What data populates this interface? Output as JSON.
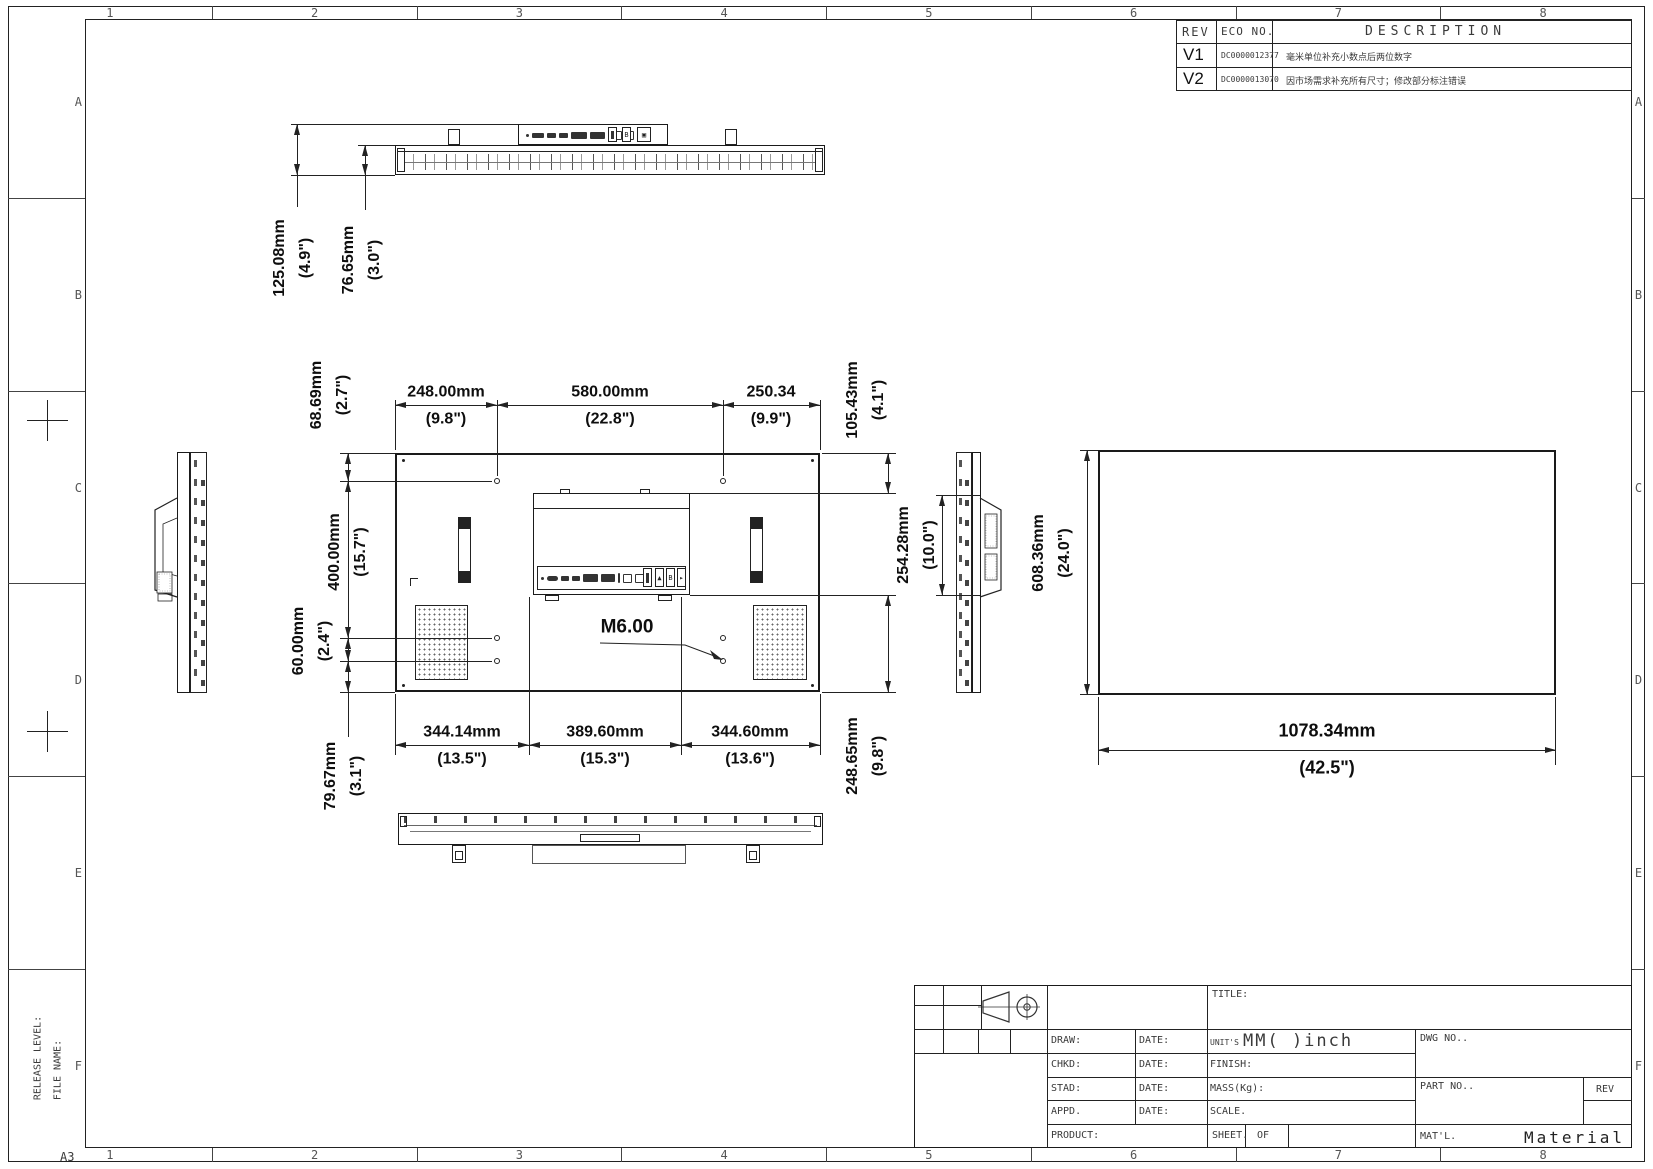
{
  "sheet": {
    "size_label": "A3",
    "grid_columns": [
      "1",
      "2",
      "3",
      "4",
      "5",
      "6",
      "7",
      "8"
    ],
    "grid_rows": [
      "A",
      "B",
      "C",
      "D",
      "E",
      "F"
    ],
    "release_level_label": "RELEASE LEVEL:",
    "file_name_label": "FILE NAME:"
  },
  "revision_table": {
    "headers": [
      "REV",
      "ECO NO.",
      "DESCRIPTION"
    ],
    "rows": [
      {
        "rev": "V1",
        "eco_no": "DC0000012377",
        "description": "毫米单位补充小数点后两位数字"
      },
      {
        "rev": "V2",
        "eco_no": "DC0000013070",
        "description": "因市场需求补充所有尺寸；修改部分标注错误"
      }
    ]
  },
  "title_block": {
    "title_label": "TITLE:",
    "draw_label": "DRAW:",
    "chkd_label": "CHKD:",
    "stad_label": "STAD:",
    "appd_label": "APPD.",
    "date_label": "DATE:",
    "product_label": "PRODUCT:",
    "units_label": "UNIT'S",
    "units_value": "MM( )inch",
    "finish_label": "FINISH:",
    "mass_label": "MASS(Kg):",
    "scale_label": "SCALE.",
    "dwg_no_label": "DWG NO..",
    "part_no_label": "PART NO..",
    "rev_label": "REV",
    "sheet_label": "SHEET.",
    "of_label": "OF",
    "matl_label": "MAT'L.",
    "material_text": "Material"
  },
  "dimensions": {
    "top_depth_total": {
      "mm": "125.08mm",
      "inch": "(4.9\")"
    },
    "top_depth_body": {
      "mm": "76.65mm",
      "inch": "(3.0\")"
    },
    "vesa_left_offset": {
      "mm": "248.00mm",
      "inch": "(9.8\")"
    },
    "vesa_width": {
      "mm": "580.00mm",
      "inch": "(22.8\")"
    },
    "vesa_right_offset": {
      "mm": "250.34",
      "inch": "(9.9\")"
    },
    "edge_to_holes_top": {
      "mm": "68.69mm",
      "inch": "(2.7\")"
    },
    "top_to_recess": {
      "mm": "105.43mm",
      "inch": "(4.1\")"
    },
    "vesa_height": {
      "mm": "400.00mm",
      "inch": "(15.7\")"
    },
    "hole_pair_gap": {
      "mm": "60.00mm",
      "inch": "(2.4\")"
    },
    "bottom_left_span": {
      "mm": "344.14mm",
      "inch": "(13.5\")"
    },
    "bottom_center_span": {
      "mm": "389.60mm",
      "inch": "(15.3\")"
    },
    "bottom_right_span": {
      "mm": "344.60mm",
      "inch": "(13.6\")"
    },
    "holes_to_bottom": {
      "mm": "79.67mm",
      "inch": "(3.1\")"
    },
    "recess_to_bottom": {
      "mm": "248.65mm",
      "inch": "(9.8\")"
    },
    "recess_height": {
      "mm": "254.28mm",
      "inch": "(10.0\")"
    },
    "display_height": {
      "mm": "608.36mm",
      "inch": "(24.0\")"
    },
    "display_width": {
      "mm": "1078.34mm",
      "inch": "(42.5\")"
    }
  },
  "annotations": {
    "thread_callout": "M6.00"
  }
}
